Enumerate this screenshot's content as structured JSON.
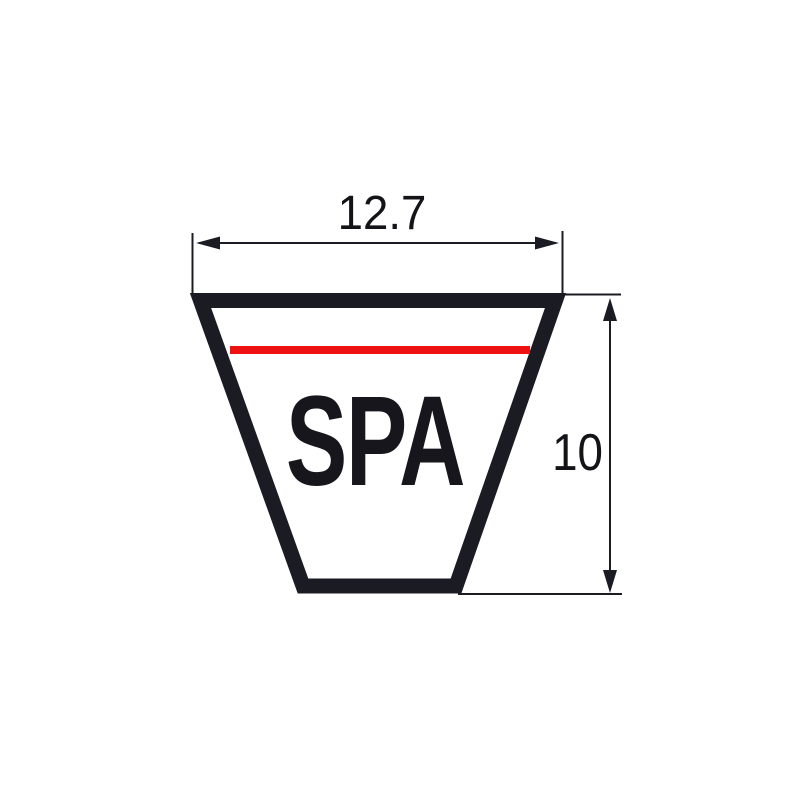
{
  "diagram": {
    "type": "technical-drawing",
    "subject": "V-belt cross-section profile",
    "profile_label": "SPA",
    "dimensions": {
      "top_width": {
        "label": "12.7"
      },
      "height": {
        "label": "10"
      }
    },
    "colors": {
      "outline": "#1b1b24",
      "pitch_line": "#ee1111",
      "dimension_lines": "#1b1b24",
      "text": "#141418",
      "background": "#ffffff"
    }
  }
}
